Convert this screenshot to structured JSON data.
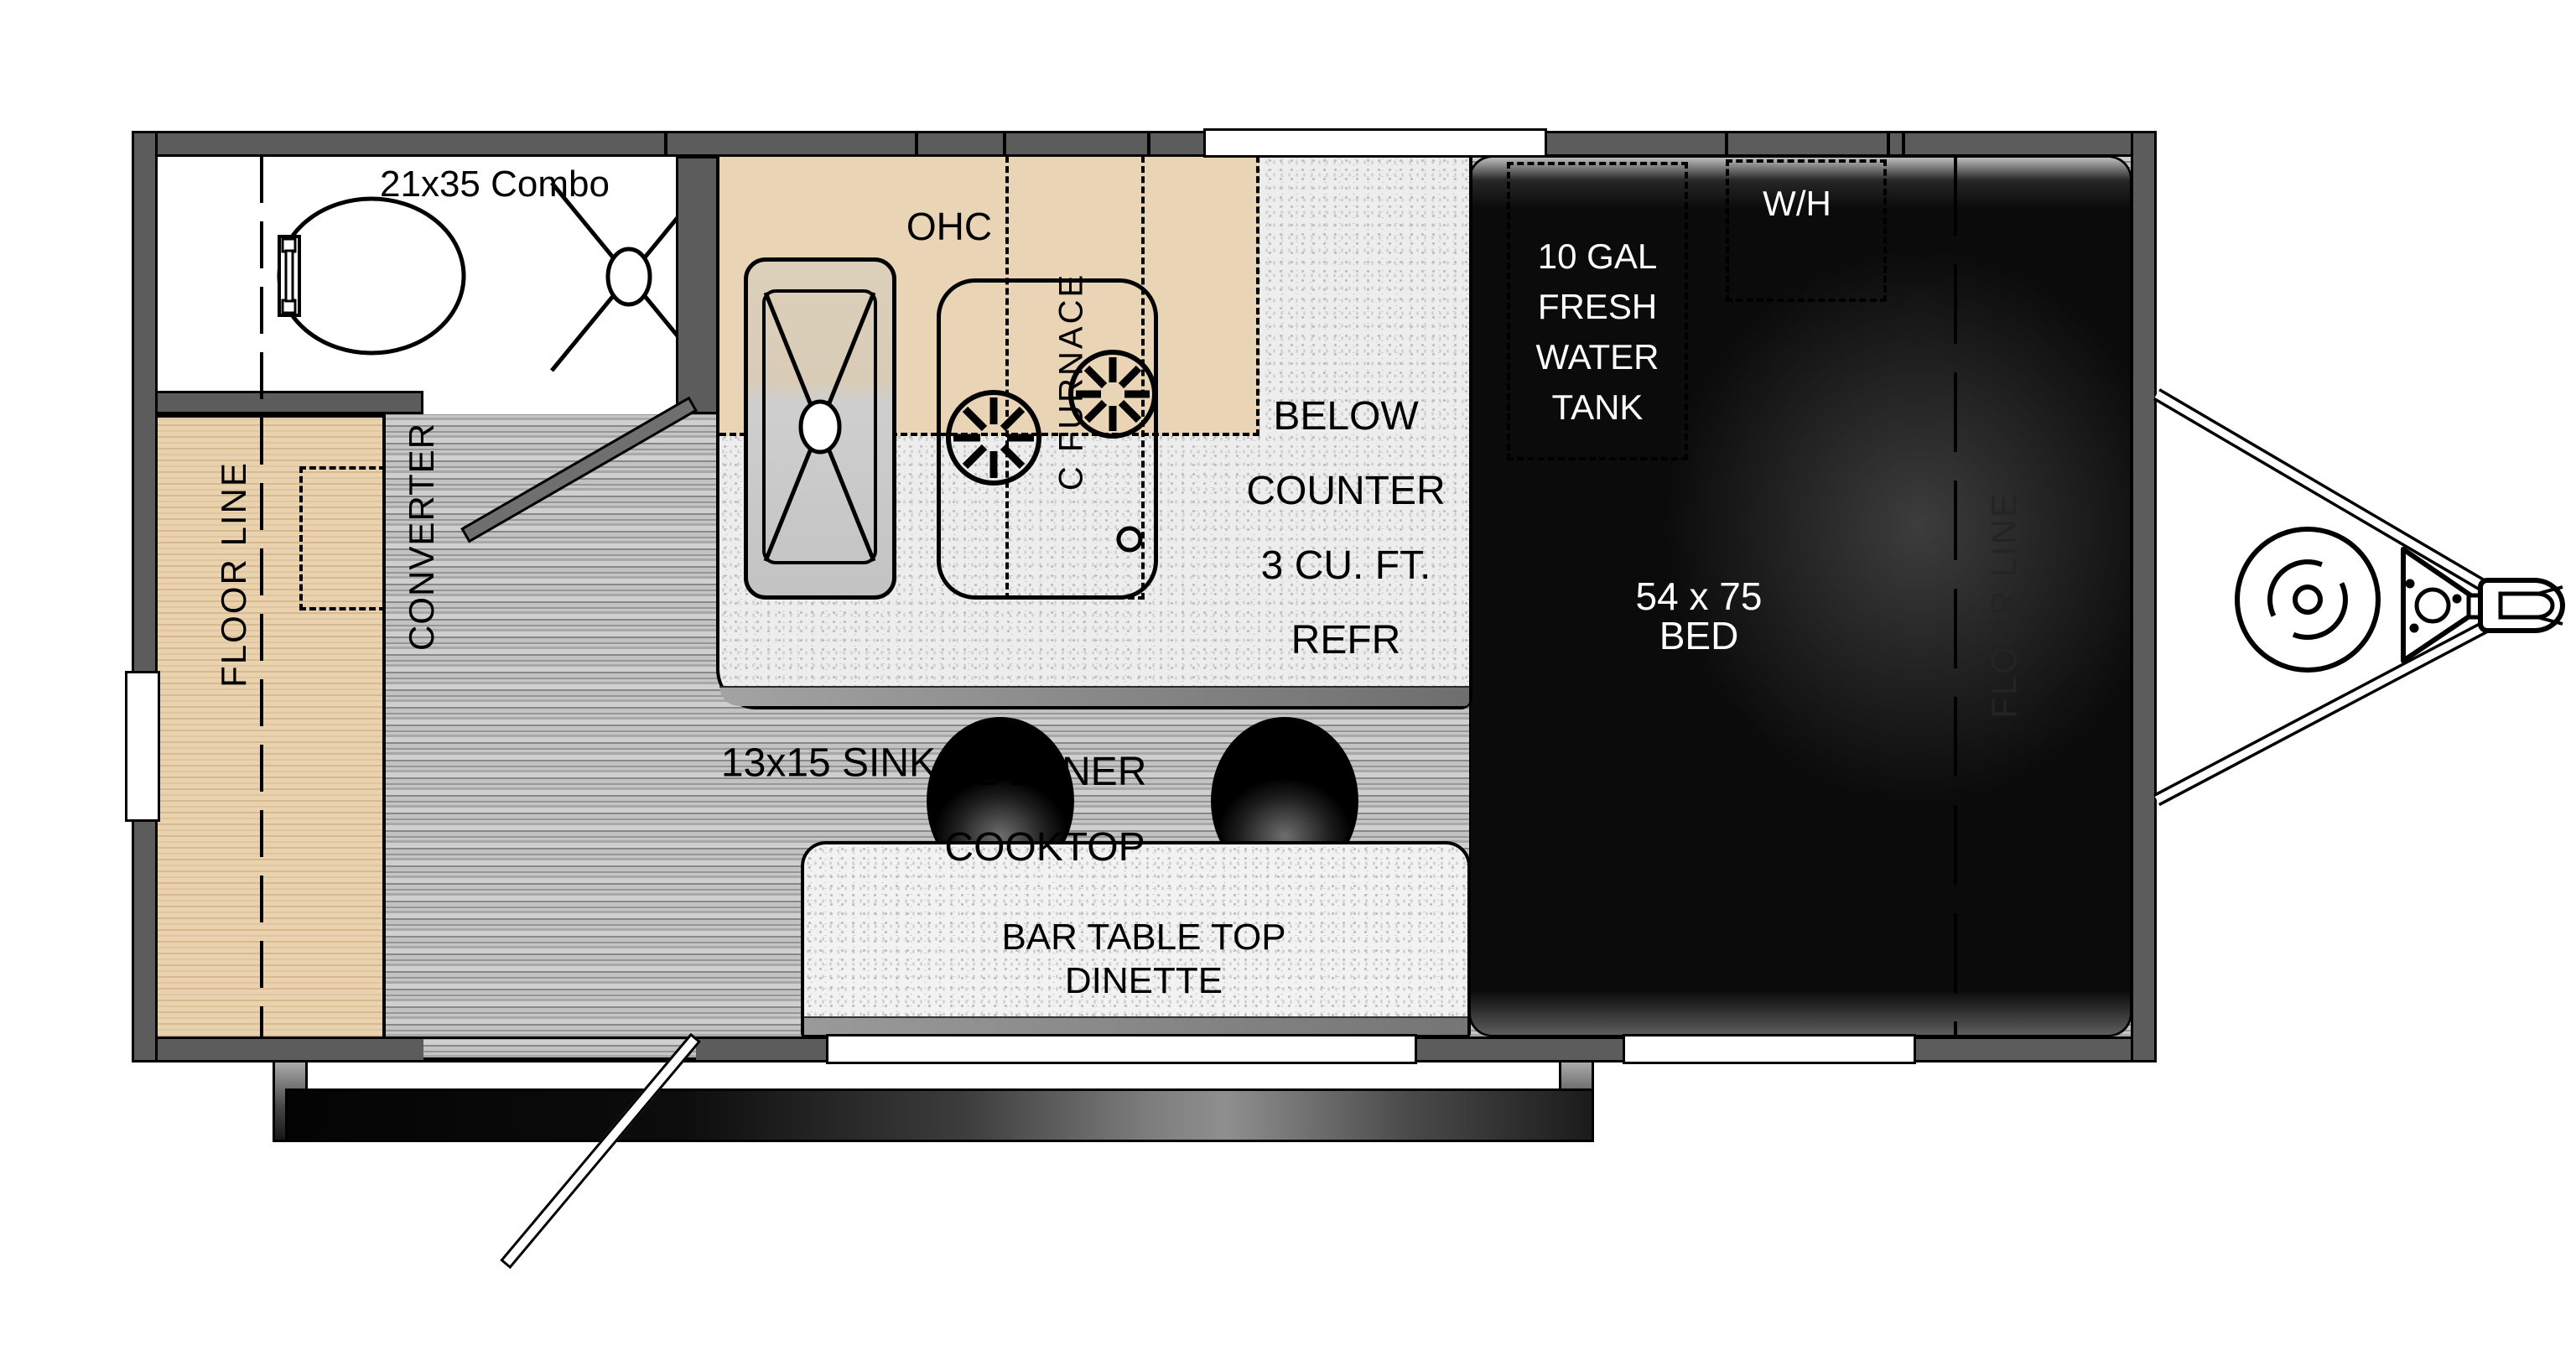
{
  "plan": {
    "type": "travel-trailer floor plan",
    "bathroom": {
      "combo_label": "21x35 Combo"
    },
    "kitchen": {
      "ohc_label": "OHC",
      "furnace_label": "C FURNACE",
      "sink_label": "13x15 SINK",
      "cooktop_lines": [
        "2 BURNER",
        "COOKTOP"
      ],
      "refrigerator_lines": [
        "BELOW",
        "COUNTER",
        "3 CU. FT.",
        "REFR"
      ]
    },
    "bedroom": {
      "tank_lines": [
        "10 GAL",
        "FRESH",
        "WATER",
        "TANK"
      ],
      "water_heater_label": "W/H",
      "bed_lines": [
        "54 x 75",
        "BED"
      ],
      "floor_line_label": "FLOOR LINE"
    },
    "living": {
      "floor_line_label": "FLOOR LINE",
      "converter_label": "CONVERTER",
      "dinette_lines": [
        "BAR TABLE TOP",
        "DINETTE"
      ]
    },
    "colors": {
      "wall": "#5c5c5c",
      "counter": "#ededed",
      "overhead_cabinet": "#e9d4b5",
      "bench": "#ead2ae",
      "bed_area": "#0b0b0b",
      "floor": "#b9b9b9",
      "label_text": "#000000",
      "bed_label_text": "#ffffff"
    }
  }
}
